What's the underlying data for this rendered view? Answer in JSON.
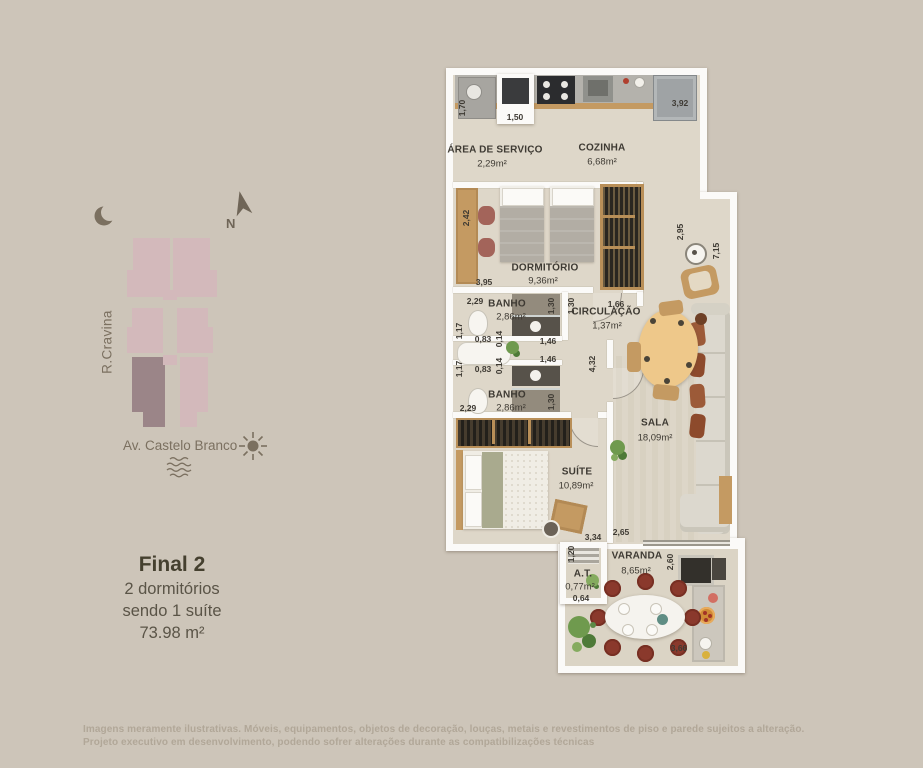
{
  "colors": {
    "background": "#cdc5b9",
    "wall": "#fbfaf8",
    "floor": "#ded7c9",
    "wood": "#c49a62",
    "site_unit": "#d3b9bb",
    "site_unit_highlight": "#9b8588",
    "site_icon": "#7b7060",
    "plan_text": "#3e3a33",
    "watermark_text": "#b1a798",
    "varanda_chair": "#8a392c"
  },
  "site_plan": {
    "north_label": "N",
    "street_left": "R.Cravina",
    "street_bottom": "Av. Castelo Branco"
  },
  "unit_info": {
    "title": "Final 2",
    "line1": "2 dormitórios",
    "line2": "sendo 1 suíte",
    "area": "73.98 m²"
  },
  "rooms": {
    "servico": {
      "name": "ÁREA DE SERVIÇO",
      "area": "2,29m²"
    },
    "cozinha": {
      "name": "COZINHA",
      "area": "6,68m²"
    },
    "dormitorio": {
      "name": "DORMITÓRIO",
      "area": "9,36m²"
    },
    "banho1": {
      "name": "BANHO",
      "area": "2,86m²"
    },
    "circulacao": {
      "name": "CIRCULAÇÃO",
      "area": "1,37m²"
    },
    "banho2": {
      "name": "BANHO",
      "area": "2,86m²"
    },
    "sala": {
      "name": "SALA",
      "area": "18,09m²"
    },
    "suite": {
      "name": "SUÍTE",
      "area": "10,89m²"
    },
    "at": {
      "name": "A.T.",
      "area": "0,77m²"
    },
    "varanda": {
      "name": "VARANDA",
      "area": "8,65m²"
    }
  },
  "dims": {
    "servico_h": "1,70",
    "servico_cab_w": "1,50",
    "cozinha_w": "3,92",
    "dorm_h": "2,42",
    "dorm_w": "3,95",
    "sala_step_h": "2,95",
    "sala_right_h": "7,15",
    "banho1_w": "2,29",
    "banho1_door_h": "1,30",
    "circ_door_h": "1,30",
    "circ_w": "1,66",
    "banho1_h2": "1,17",
    "banho1_w2": "0,83",
    "banho1_gap": "0,14",
    "banho1_niche_w": "1,46",
    "banho2_niche_w": "1,46",
    "ban2_gap": "0,14",
    "banho2_w2": "0,83",
    "banho2_h2": "1,17",
    "banho2_w": "2,29",
    "banho2_door_h": "1,30",
    "sala_wall_h": "4,32",
    "suite_w": "3,34",
    "sala_w": "2,65",
    "at_h": "1,20",
    "at_w": "0,64",
    "varanda_h": "2,60",
    "varanda_w": "3,66"
  },
  "disclaimer": {
    "line1": "Imagens meramente ilustrativas. Móveis, equipamentos, objetos de decoração, louças, metais e revestimentos de piso e parede sujeitos a alteração.",
    "line2": "Projeto executivo em desenvolvimento, podendo sofrer alterações durante as compatibilizações técnicas"
  }
}
